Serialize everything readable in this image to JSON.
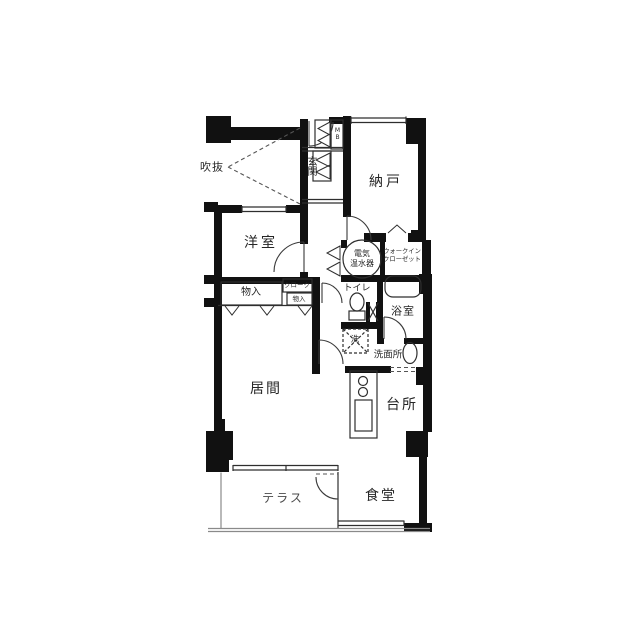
{
  "labels": {
    "void": "吹抜",
    "entrance": "玄関",
    "meter_box": "MB",
    "storage_room": "納戸",
    "western_room": "洋室",
    "water_heater_line1": "電気",
    "water_heater_line2": "温水器",
    "walkin_line1": "ウォークイン",
    "walkin_line2": "クローゼット",
    "cloak": "クローク",
    "closet_small": "物入",
    "closet": "物入",
    "toilet": "トイレ",
    "bathroom": "浴室",
    "washer": "洗",
    "washroom": "洗面所",
    "living_room": "居間",
    "kitchen": "台所",
    "terrace": "テラス",
    "dining_room": "食堂"
  },
  "colors": {
    "wall": "#111111",
    "line": "#2e2e2e",
    "light_line": "#8a8a8a",
    "text": "#262626",
    "background": "#ffffff"
  }
}
